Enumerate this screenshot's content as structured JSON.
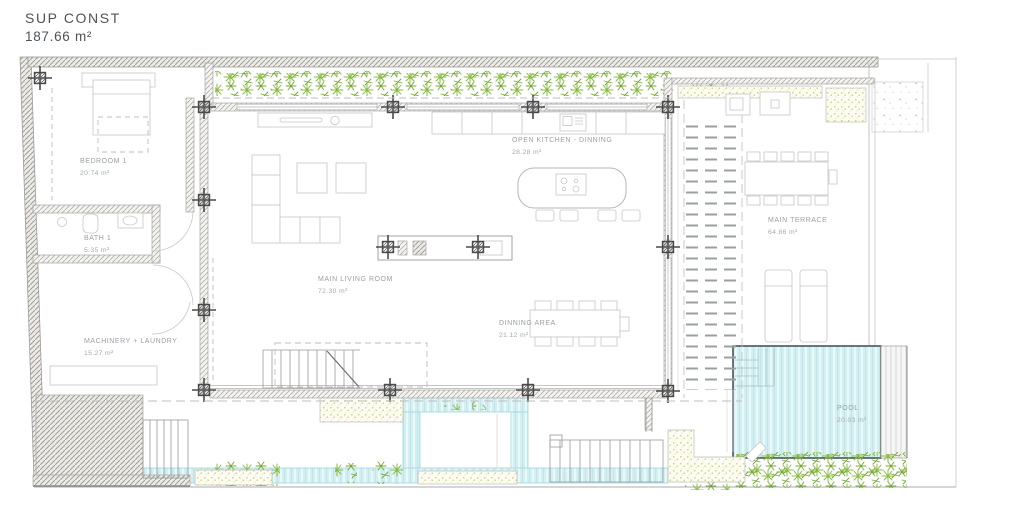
{
  "title": {
    "label": "SUP CONST",
    "value": "187.66 m²"
  },
  "rooms": [
    {
      "key": "bedroom-1",
      "name": "BEDROOM 1",
      "area": "20.74 m²"
    },
    {
      "key": "bath-1",
      "name": "BATH 1",
      "area": "5.35 m²"
    },
    {
      "key": "machinery-laundry",
      "name": "MACHINERY + LAUNDRY",
      "area": "15.27 m²"
    },
    {
      "key": "main-living-room",
      "name": "MAIN LIVING ROOM",
      "area": "72.30 m²"
    },
    {
      "key": "open-kitchen-dinning",
      "name": "OPEN KITCHEN - DINNING",
      "area": "28.28 m²"
    },
    {
      "key": "dinning-area",
      "name": "DINNING AREA",
      "area": "21.12 m²"
    },
    {
      "key": "main-terrace",
      "name": "MAIN TERRACE",
      "area": "64.86 m²"
    },
    {
      "key": "pool",
      "name": "POOL",
      "area": "20.03 m²"
    }
  ],
  "colors": {
    "pool_fill": "#d3eff1",
    "pool_stripe": "#b9e6ea",
    "greenery": "#8abb43",
    "planter_dots": "#c9cd74",
    "wall_hatch": "#b3b1ac",
    "label_text": "#9aa0a6",
    "title_text": "#4f5358"
  }
}
